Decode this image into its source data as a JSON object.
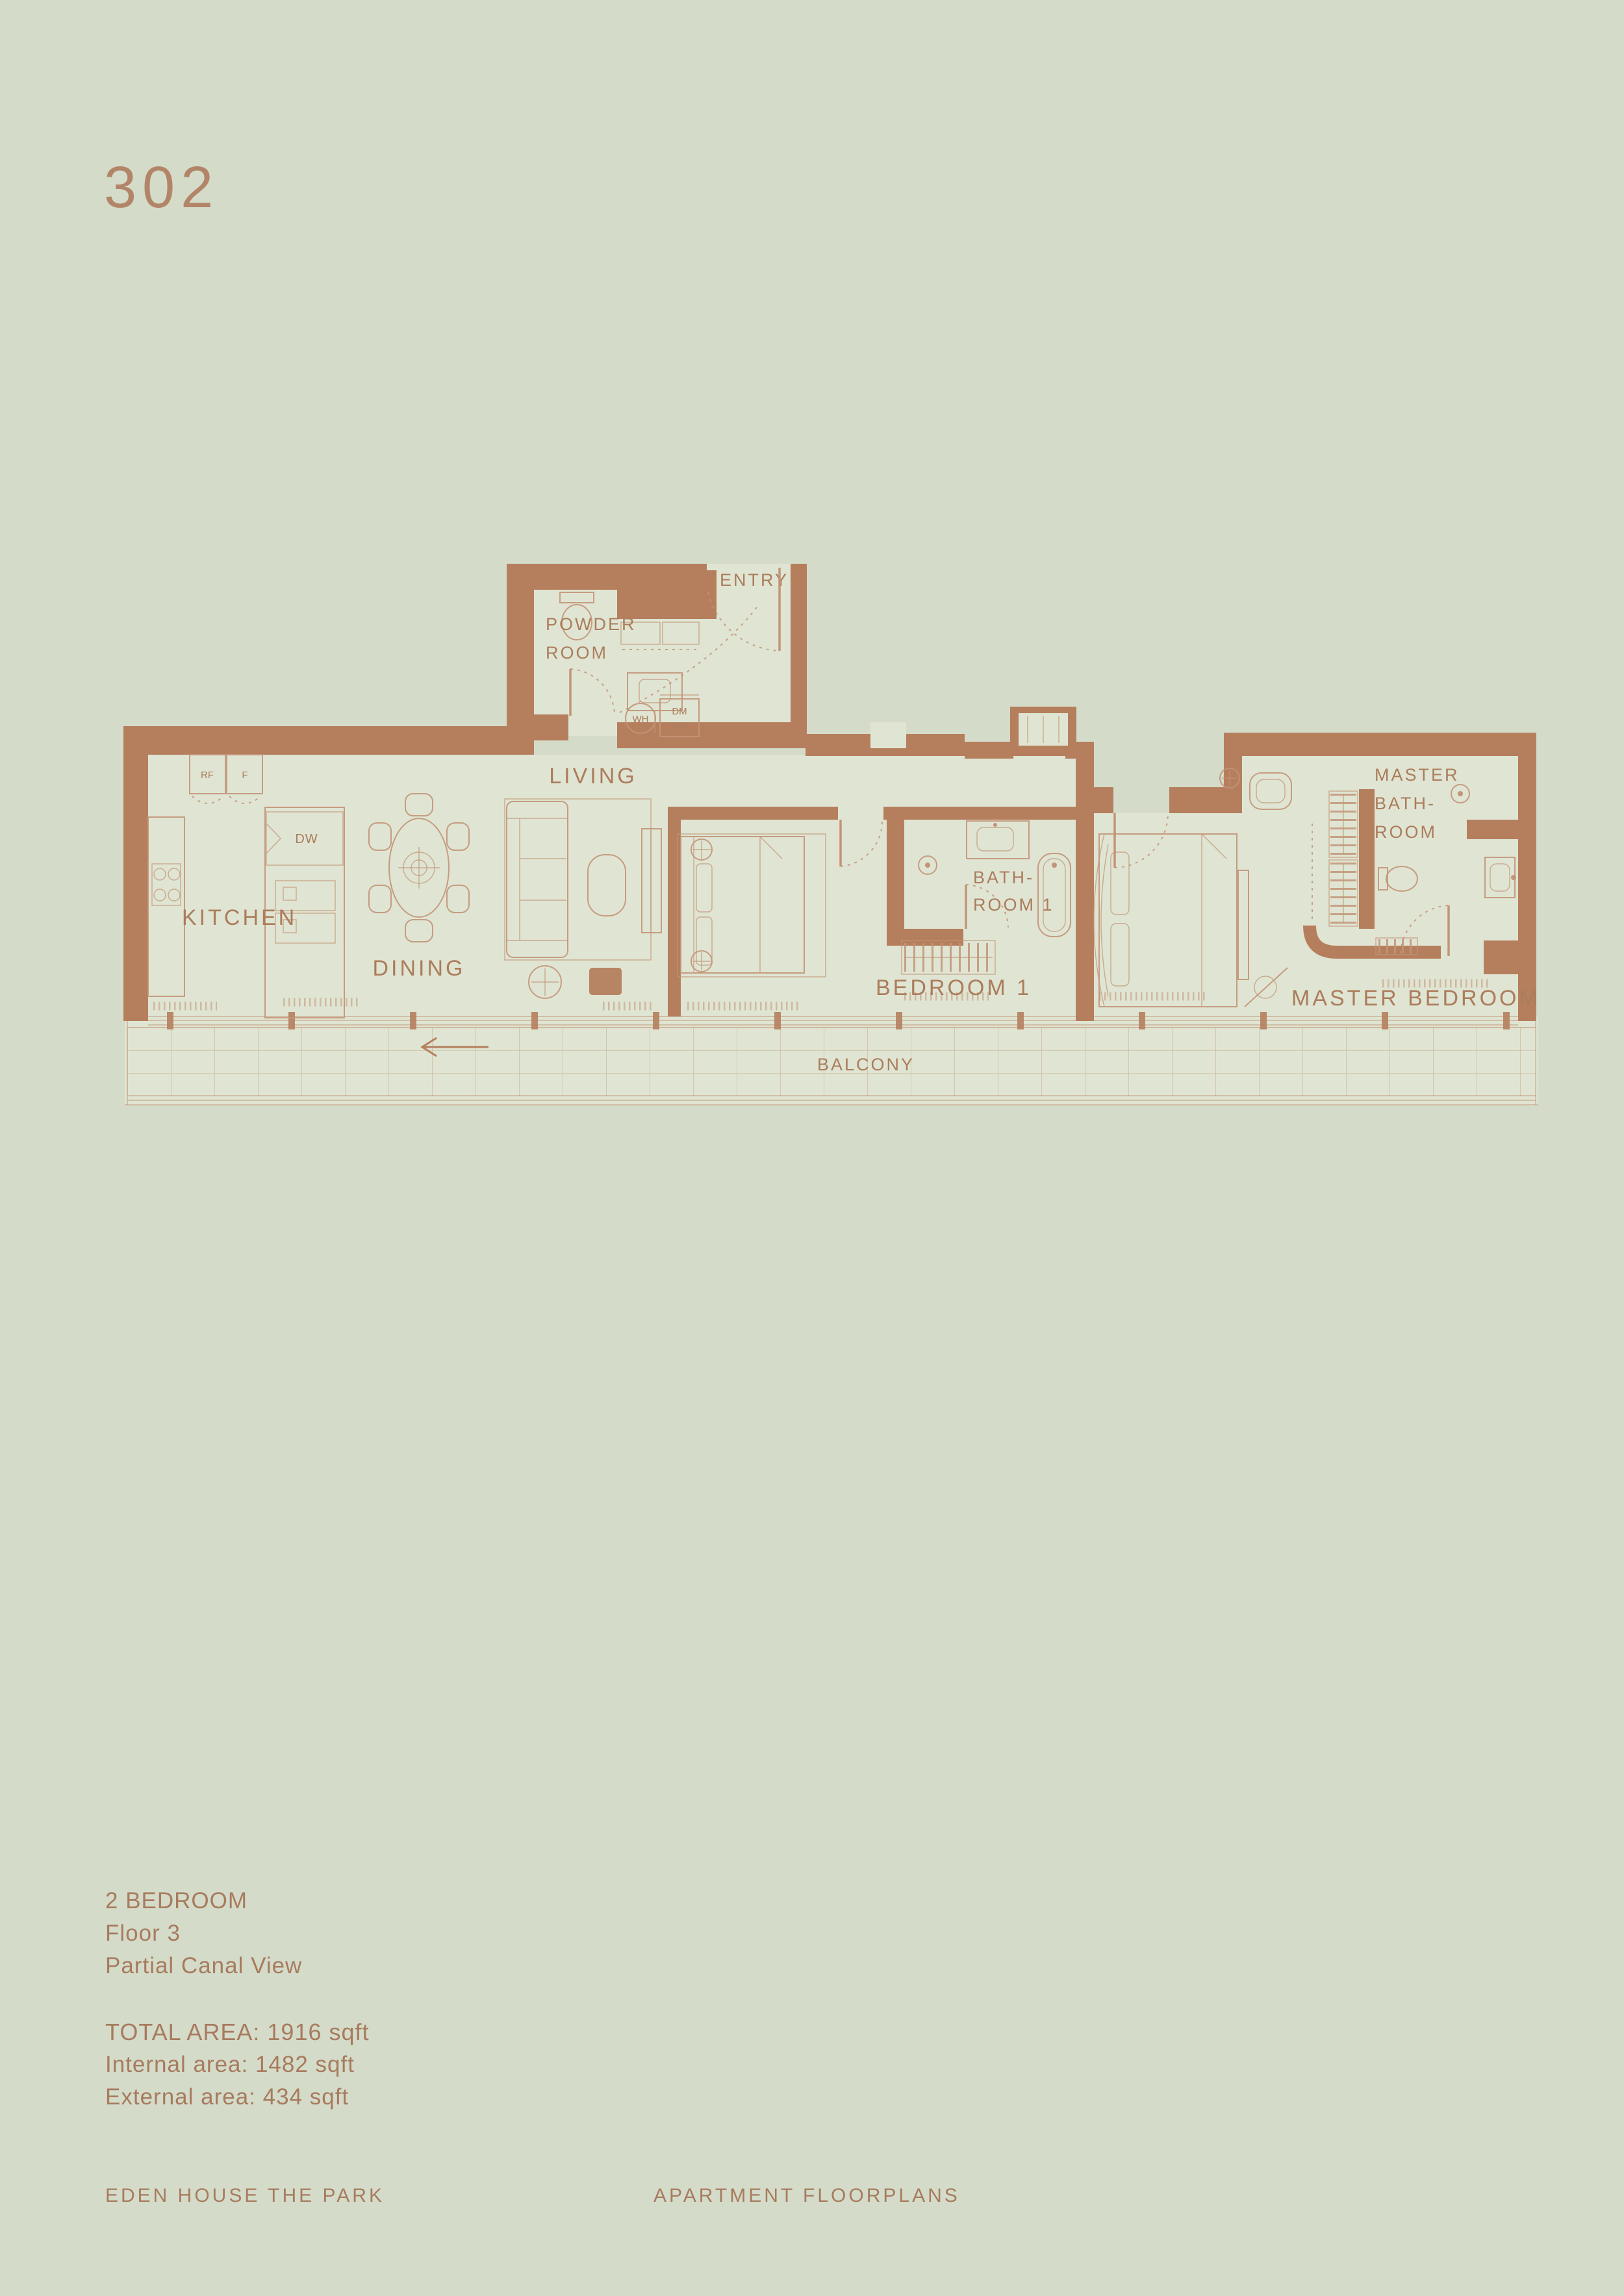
{
  "theme": {
    "bg": "#d4dbc9",
    "floor": "#dfe5d2",
    "wall": "#b57f5e",
    "line": "#c39478",
    "label": "#ac7c5c",
    "text": "#a87b5e",
    "accent": "#b28568"
  },
  "unit": {
    "number": "302"
  },
  "plan": {
    "labels": {
      "entry": "ENTRY",
      "powder_line1": "POWDER",
      "powder_line2": "ROOM",
      "living": "LIVING",
      "kitchen": "KITCHEN",
      "dining": "DINING",
      "bath1_line1": "BATH-",
      "bath1_line2": "ROOM 1",
      "bedroom1": "BEDROOM 1",
      "master_bath_line1": "MASTER",
      "master_bath_line2": "BATH-",
      "master_bath_line3": "ROOM",
      "master_bedroom": "MASTER BEDROOM",
      "balcony": "BALCONY"
    },
    "fixtures": {
      "rf": "RF",
      "f": "F",
      "dw": "DW",
      "wh": "WH",
      "dm": "DM",
      "wm": "WM"
    }
  },
  "details": {
    "bedrooms": "2 BEDROOM",
    "floor": "Floor 3",
    "view": "Partial Canal View",
    "total_area": "TOTAL AREA: 1916 sqft",
    "internal_area": "Internal area: 1482 sqft",
    "external_area": "External area: 434 sqft"
  },
  "footer": {
    "project": "EDEN HOUSE THE PARK",
    "section": "APARTMENT FLOORPLANS"
  }
}
